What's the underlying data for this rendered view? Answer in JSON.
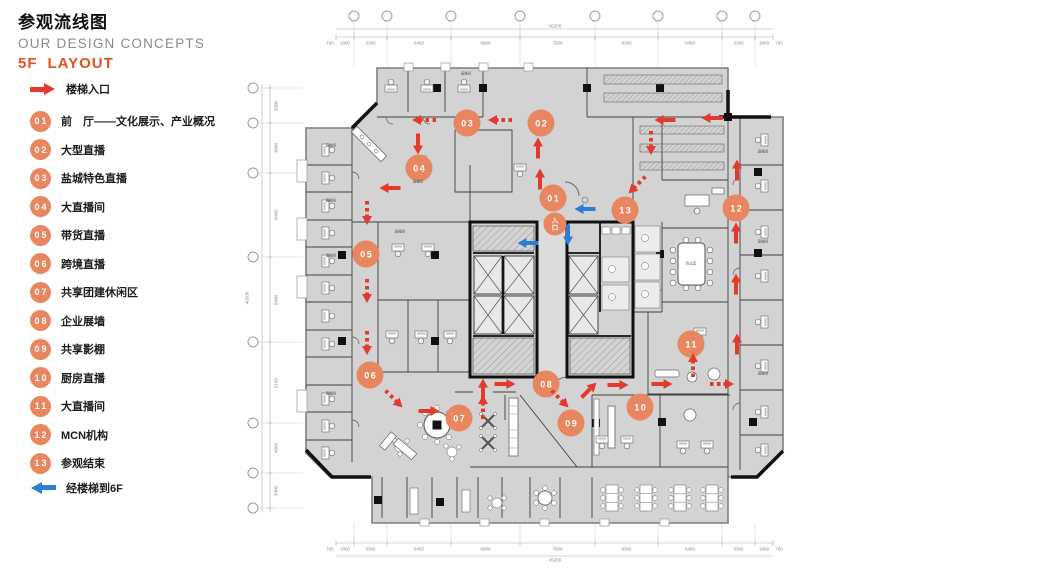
{
  "header": {
    "title_zh": "参观流线图",
    "title_en": "OUR DESIGN CONCEPTS",
    "floor_label": "5F",
    "layout_label": "LAYOUT"
  },
  "legend": {
    "stair_entry_label": "楼梯入口",
    "to_6f_label": "经楼梯到6F",
    "items": [
      {
        "num": "01",
        "label": "前　厅——文化展示、产业概况"
      },
      {
        "num": "02",
        "label": "大型直播"
      },
      {
        "num": "03",
        "label": "盐城特色直播"
      },
      {
        "num": "04",
        "label": "大直播间"
      },
      {
        "num": "05",
        "label": "带货直播"
      },
      {
        "num": "06",
        "label": "跨境直播"
      },
      {
        "num": "07",
        "label": "共享团建休闲区"
      },
      {
        "num": "08",
        "label": "企业展墙"
      },
      {
        "num": "09",
        "label": "共享影棚"
      },
      {
        "num": "10",
        "label": "厨房直播"
      },
      {
        "num": "11",
        "label": "大直播间"
      },
      {
        "num": "12",
        "label": "MCN机构"
      },
      {
        "num": "13",
        "label": "参观结束"
      }
    ]
  },
  "plan": {
    "entrance_badge": {
      "label": "入口",
      "x": 555,
      "y": 224
    },
    "markers": [
      {
        "num": "01",
        "x": 553,
        "y": 198
      },
      {
        "num": "02",
        "x": 541,
        "y": 123
      },
      {
        "num": "03",
        "x": 467,
        "y": 123
      },
      {
        "num": "04",
        "x": 419,
        "y": 168
      },
      {
        "num": "05",
        "x": 366,
        "y": 254
      },
      {
        "num": "06",
        "x": 370,
        "y": 375
      },
      {
        "num": "07",
        "x": 459,
        "y": 418
      },
      {
        "num": "08",
        "x": 546,
        "y": 384
      },
      {
        "num": "09",
        "x": 571,
        "y": 423
      },
      {
        "num": "10",
        "x": 640,
        "y": 407
      },
      {
        "num": "11",
        "x": 691,
        "y": 344
      },
      {
        "num": "12",
        "x": 736,
        "y": 208
      },
      {
        "num": "13",
        "x": 625,
        "y": 210
      }
    ],
    "red_arrows": [
      {
        "x": 424,
        "y": 120,
        "angle": 180,
        "dashed": true
      },
      {
        "x": 500,
        "y": 120,
        "angle": 180,
        "dashed": true
      },
      {
        "x": 665,
        "y": 120,
        "angle": 180,
        "dashed": false
      },
      {
        "x": 712,
        "y": 118,
        "angle": 180,
        "dashed": false
      },
      {
        "x": 418,
        "y": 144,
        "angle": 90,
        "dashed": false
      },
      {
        "x": 538,
        "y": 148,
        "angle": 270,
        "dashed": false
      },
      {
        "x": 540,
        "y": 179,
        "angle": 270,
        "dashed": false
      },
      {
        "x": 651,
        "y": 143,
        "angle": 90,
        "dashed": true
      },
      {
        "x": 637,
        "y": 185,
        "angle": 135,
        "dashed": true
      },
      {
        "x": 737,
        "y": 170,
        "angle": 270,
        "dashed": false
      },
      {
        "x": 390,
        "y": 188,
        "angle": 180,
        "dashed": false
      },
      {
        "x": 367,
        "y": 213,
        "angle": 90,
        "dashed": true
      },
      {
        "x": 367,
        "y": 291,
        "angle": 90,
        "dashed": true
      },
      {
        "x": 367,
        "y": 343,
        "angle": 90,
        "dashed": true
      },
      {
        "x": 736,
        "y": 233,
        "angle": 270,
        "dashed": false
      },
      {
        "x": 736,
        "y": 284,
        "angle": 270,
        "dashed": false
      },
      {
        "x": 737,
        "y": 344,
        "angle": 270,
        "dashed": false
      },
      {
        "x": 483,
        "y": 389,
        "angle": 270,
        "dashed": false
      },
      {
        "x": 505,
        "y": 384,
        "angle": 0,
        "dashed": false
      },
      {
        "x": 483,
        "y": 407,
        "angle": 270,
        "dashed": true
      },
      {
        "x": 394,
        "y": 399,
        "angle": 45,
        "dashed": true
      },
      {
        "x": 429,
        "y": 411,
        "angle": 0,
        "dashed": false
      },
      {
        "x": 560,
        "y": 399,
        "angle": 45,
        "dashed": true
      },
      {
        "x": 589,
        "y": 390,
        "angle": 315,
        "dashed": false
      },
      {
        "x": 618,
        "y": 385,
        "angle": 0,
        "dashed": false
      },
      {
        "x": 662,
        "y": 384,
        "angle": 0,
        "dashed": false
      },
      {
        "x": 722,
        "y": 384,
        "angle": 0,
        "dashed": true
      },
      {
        "x": 693,
        "y": 365,
        "angle": 270,
        "dashed": true
      }
    ],
    "blue_arrows": [
      {
        "x": 585,
        "y": 209,
        "angle": 180
      },
      {
        "x": 568,
        "y": 235,
        "angle": 90
      },
      {
        "x": 528,
        "y": 243,
        "angle": 180
      }
    ],
    "room_labels": [
      {
        "text": "直播间",
        "x": 331,
        "y": 146
      },
      {
        "text": "直播间",
        "x": 331,
        "y": 201
      },
      {
        "text": "直播间",
        "x": 331,
        "y": 256
      },
      {
        "text": "直播间",
        "x": 331,
        "y": 394
      },
      {
        "text": "直播间",
        "x": 400,
        "y": 232
      },
      {
        "text": "直播间",
        "x": 418,
        "y": 182
      },
      {
        "text": "直播间",
        "x": 763,
        "y": 152
      },
      {
        "text": "直播间",
        "x": 763,
        "y": 242
      },
      {
        "text": "直播间",
        "x": 763,
        "y": 374
      },
      {
        "text": "直播间",
        "x": 466,
        "y": 74
      },
      {
        "text": "会议室",
        "x": 691,
        "y": 264
      }
    ],
    "dimensions": {
      "ticks_x": [
        336,
        354,
        387,
        451,
        520,
        595,
        658,
        722,
        755,
        773
      ],
      "top_values": [
        "1800",
        "3300",
        "6450",
        "6900",
        "7500",
        "6300",
        "6450",
        "3300",
        "1800"
      ],
      "bottom_values": [
        "1800",
        "3300",
        "6450",
        "6900",
        "7500",
        "6300",
        "6450",
        "3300",
        "1800"
      ],
      "end_value": "700",
      "top_total": "45200",
      "bottom_total": "45200",
      "left_ticks_y": [
        88,
        123,
        173,
        257,
        342,
        423,
        473,
        508
      ],
      "left_values": [
        "3300",
        "4800",
        "8400",
        "8400",
        "8100",
        "4800",
        "3300"
      ],
      "left_total": "40200"
    }
  },
  "colors": {
    "accent_orange": "#e8875f",
    "title_orange": "#e2511f",
    "arrow_red": "#e23b2e",
    "arrow_blue": "#2a7fd4",
    "floor_gray": "#d3d3d3"
  }
}
